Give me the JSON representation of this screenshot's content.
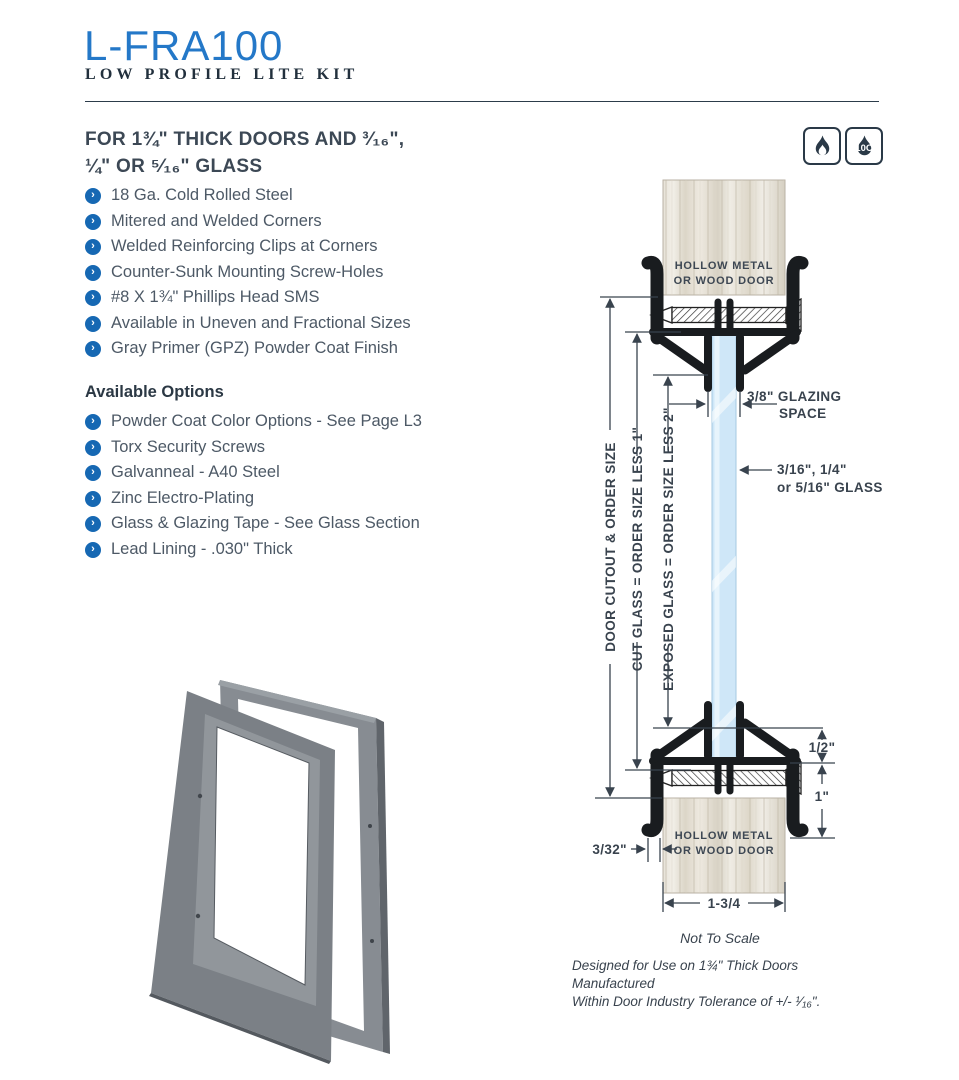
{
  "page": {
    "title": "L-FRA100",
    "subtitle": "LOW PROFILE LITE KIT"
  },
  "intro": {
    "heading_line1": "FOR 1¾\" THICK DOORS AND ³⁄₁₆\",",
    "heading_line2": "¼\" OR ⁵⁄₁₆\" GLASS",
    "fire_icon_label": "10C"
  },
  "features": [
    "18 Ga. Cold Rolled Steel",
    "Mitered and Welded Corners",
    "Welded Reinforcing Clips at Corners",
    "Counter-Sunk Mounting Screw-Holes",
    "#8 X 1¾\" Phillips Head SMS",
    "Available in Uneven and Fractional Sizes",
    "Gray Primer (GPZ) Powder Coat Finish"
  ],
  "options_heading": "Available Options",
  "options": [
    "Powder Coat Color Options - See Page L3",
    "Torx Security Screws",
    "Galvanneal - A40 Steel",
    "Zinc Electro-Plating",
    "Glass & Glazing Tape - See Glass Section",
    "Lead Lining - .030\" Thick"
  ],
  "diagram": {
    "door_top_line1": "HOLLOW METAL",
    "door_top_line2": "OR WOOD DOOR",
    "door_bottom_line1": "HOLLOW METAL",
    "door_bottom_line2": "OR WOOD DOOR",
    "dim_door_cutout": "DOOR CUTOUT & ORDER SIZE",
    "dim_cut_glass": "CUT GLASS = ORDER SIZE LESS 1\"",
    "dim_exposed_glass": "EXPOSED GLASS = ORDER SIZE LESS 2\"",
    "dim_glazing_line1": "3/8\" GLAZING",
    "dim_glazing_line2": "SPACE",
    "dim_glass_line1": "3/16\", 1/4\"",
    "dim_glass_line2": "or 5/16\" GLASS",
    "dim_half": "1/2\"",
    "dim_one": "1\"",
    "dim_3_32": "3/32\"",
    "dim_width": "1-3/4",
    "not_to_scale": "Not To Scale",
    "footnote_line1": "Designed for Use on 1¾\" Thick Doors Manufactured",
    "footnote_line2": "Within Door Industry Tolerance of +/- ¹⁄₁₆\"."
  },
  "colors": {
    "accent_blue": "#2478c8",
    "navy": "#22303d",
    "body_text": "#4d5966",
    "bullet_blue": "#1668b3",
    "glass_blue": "#cfe7f8",
    "frame_black": "#191c1f",
    "steel_gray": "#7b8086"
  }
}
